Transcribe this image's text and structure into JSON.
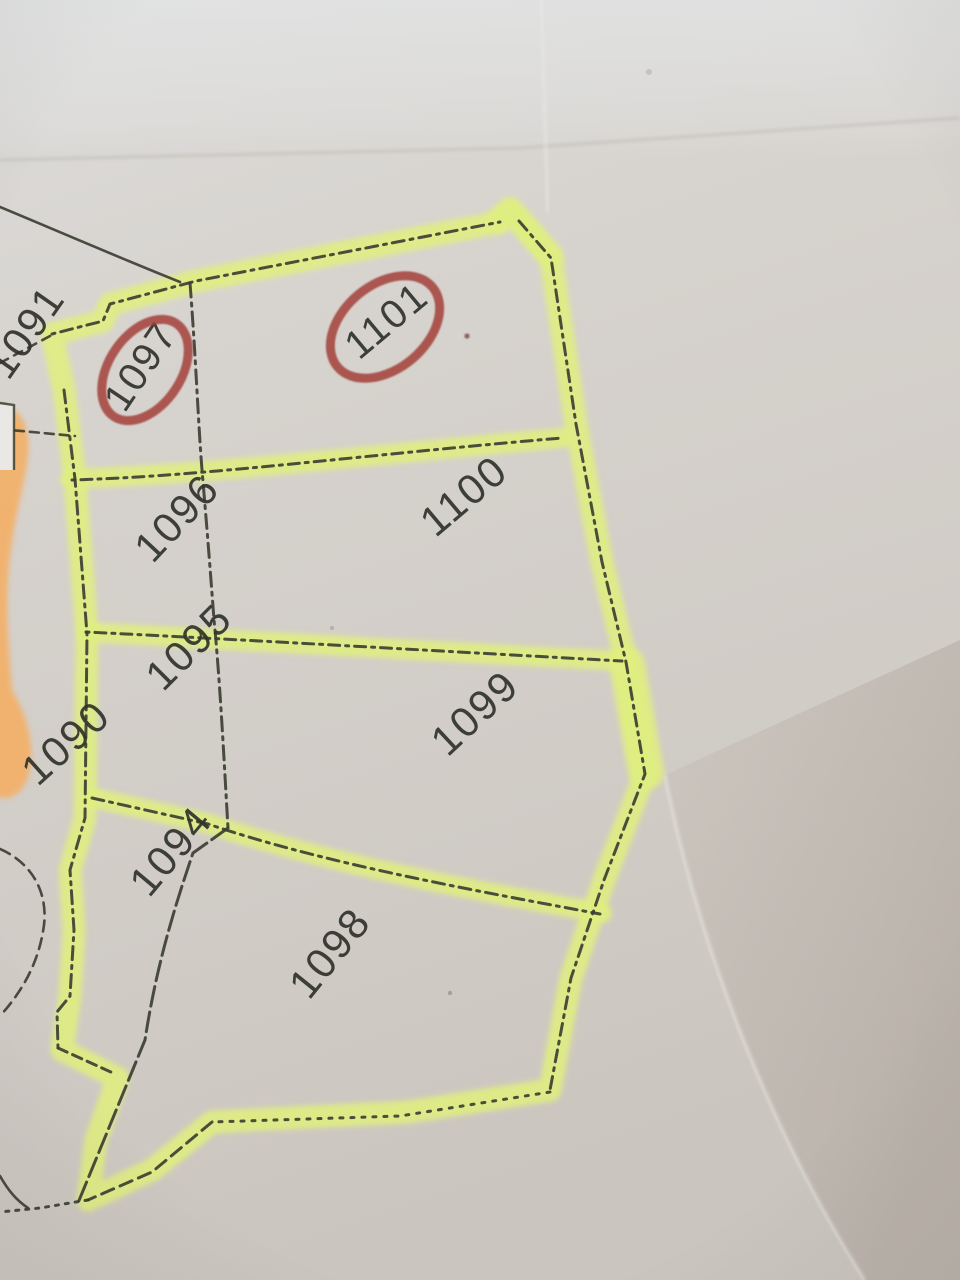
{
  "scene": {
    "description": "Photograph of a paper cadastral parcel map; a block of parcels is outlined with yellow-green highlighter, an orange highlighter strip runs along the left edge, and parcels 1097 and 1101 are circled in red pen.",
    "colors": {
      "paper": "#d5d1cc",
      "highlighter": "#e0ef7f",
      "orange_highlighter": "#f5ae63",
      "red_pen": "#a3403a",
      "map_lines": "#3c3f32",
      "labels": "#30332b"
    }
  },
  "parcels": [
    {
      "label": "1091",
      "circled": false
    },
    {
      "label": "1097",
      "circled": true
    },
    {
      "label": "1101",
      "circled": true
    },
    {
      "label": "1096",
      "circled": false
    },
    {
      "label": "1100",
      "circled": false
    },
    {
      "label": "1095",
      "circled": false
    },
    {
      "label": "1099",
      "circled": false
    },
    {
      "label": "1090",
      "circled": false
    },
    {
      "label": "1094",
      "circled": false
    },
    {
      "label": "1098",
      "circled": false
    }
  ]
}
